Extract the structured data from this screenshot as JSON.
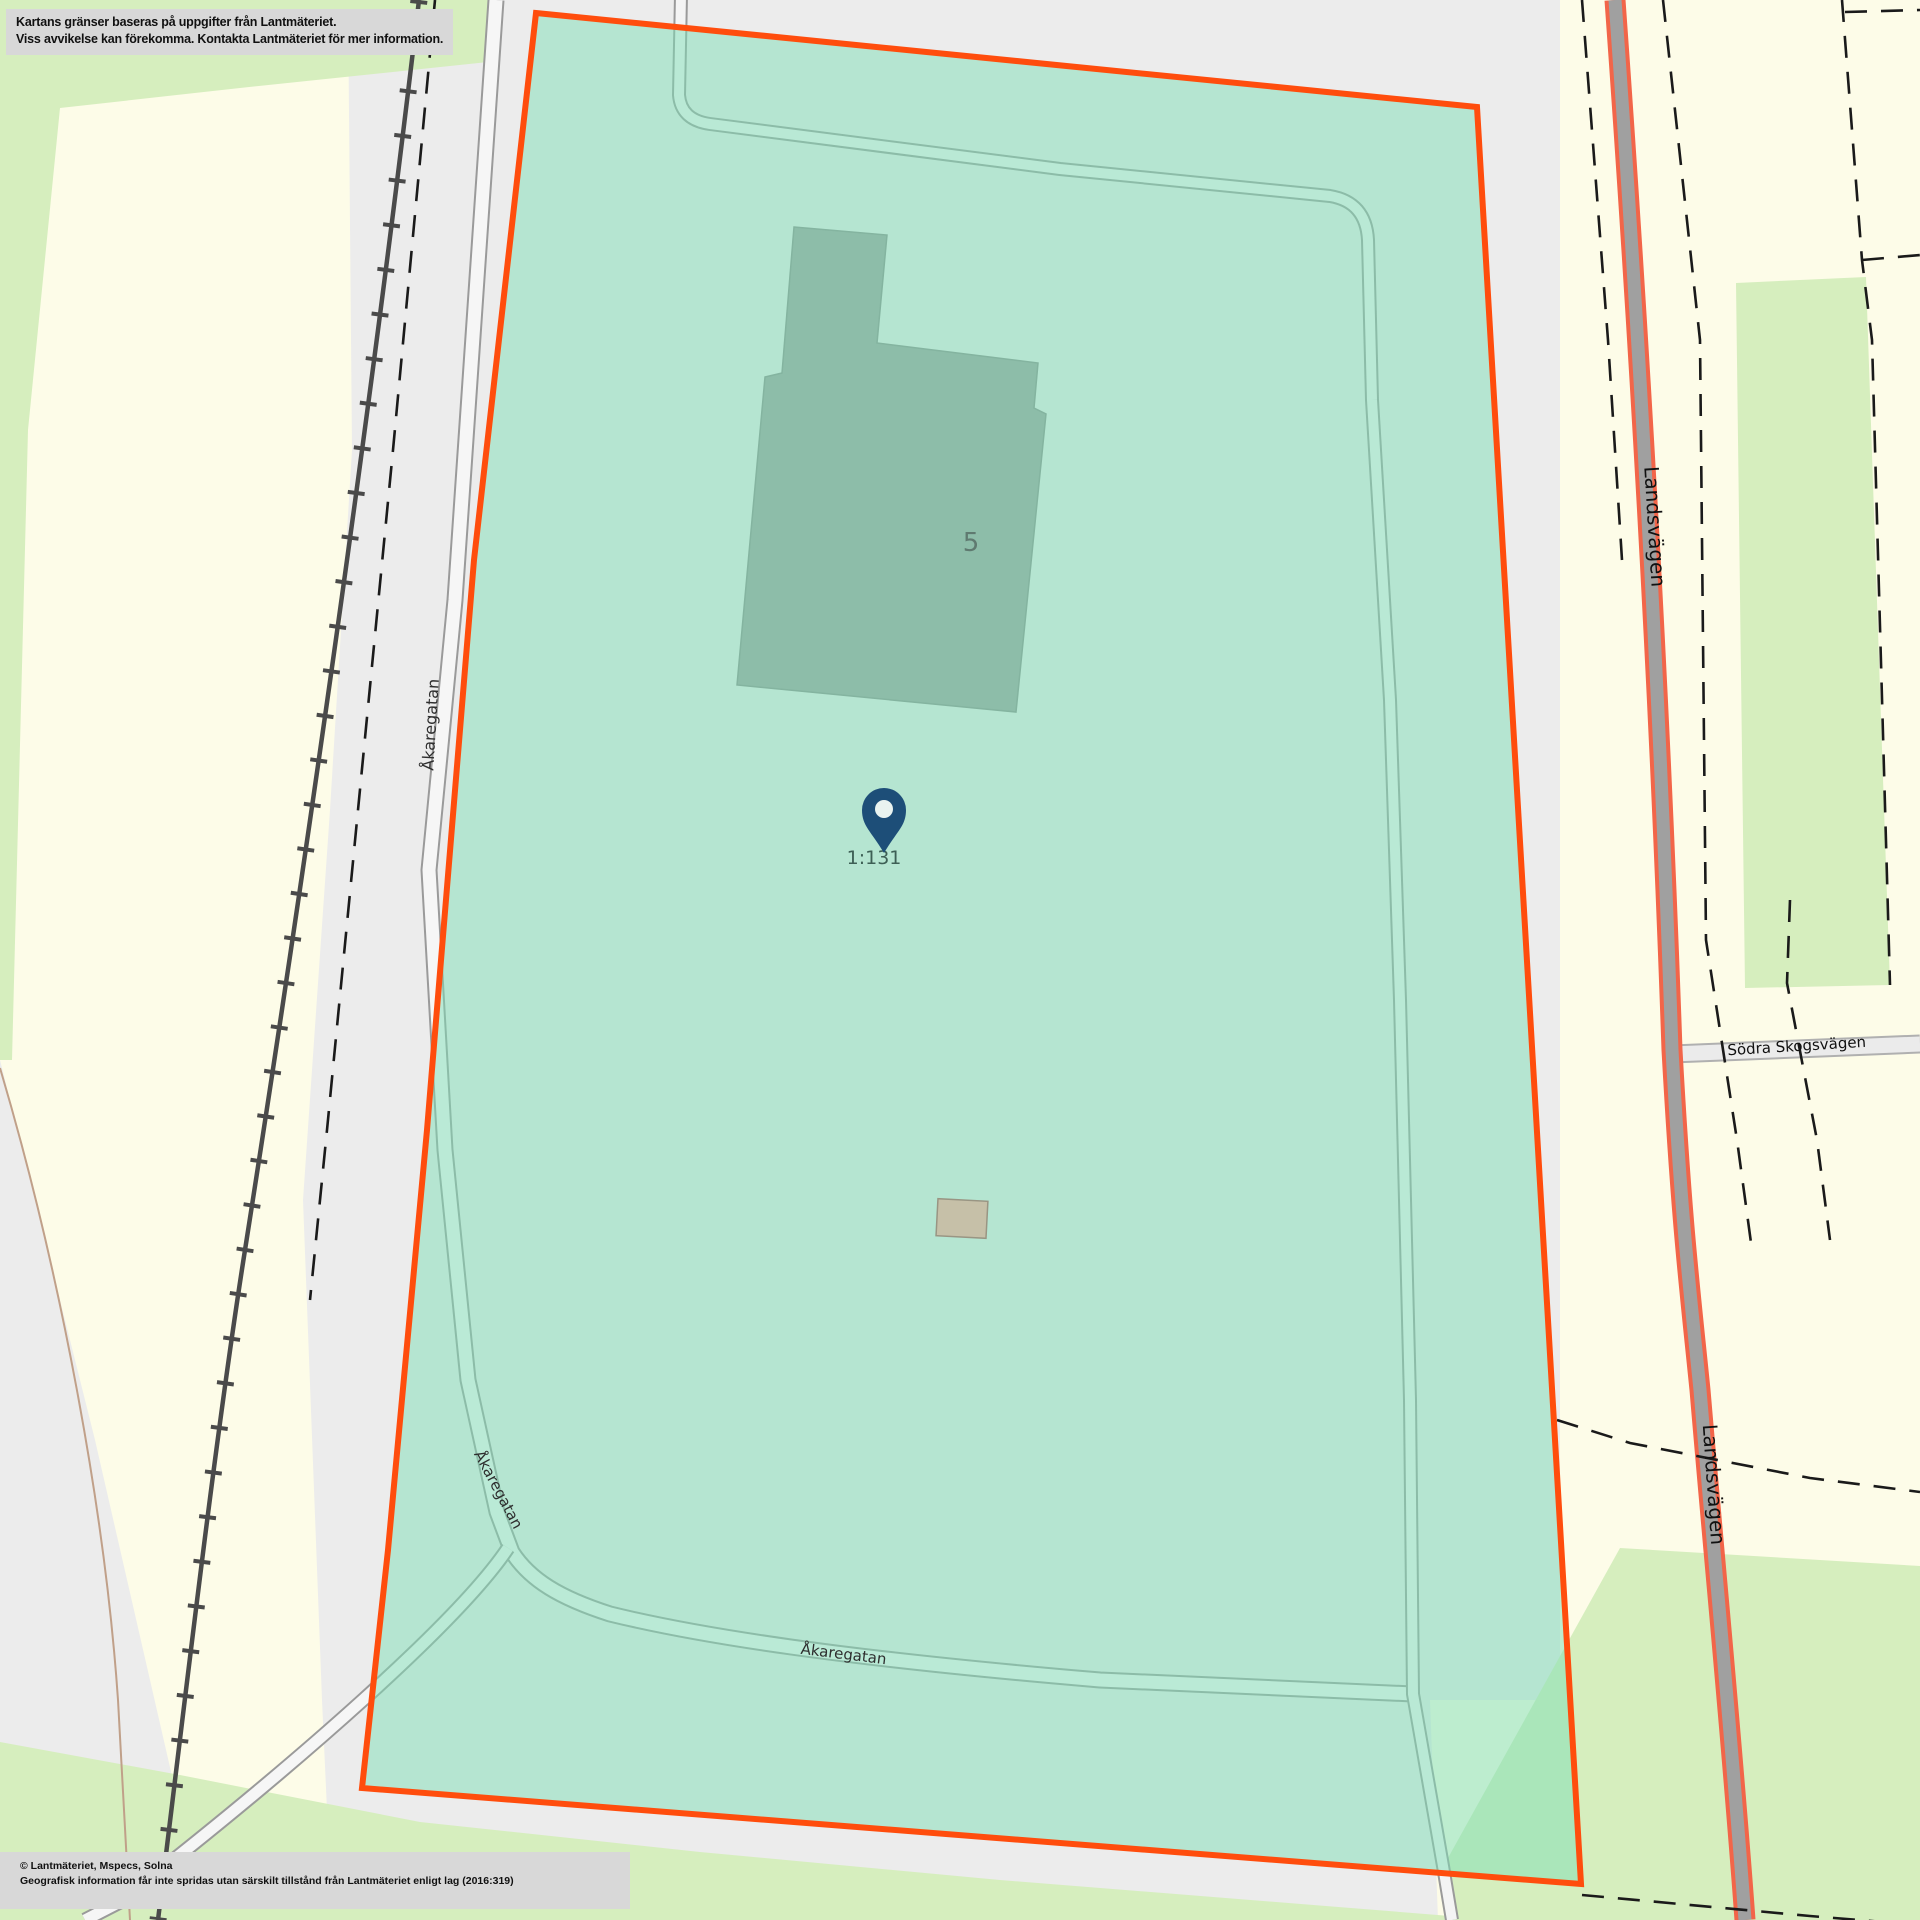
{
  "map": {
    "disclaimer": {
      "line1": "Kartans gränser baseras på uppgifter från Lantmäteriet.",
      "line2": "Viss avvikelse kan förekomma. Kontakta Lantmäteriet för mer information."
    },
    "attribution": {
      "line1": "© Lantmäteriet, Mspecs, Solna",
      "line2": "Geografisk information får inte spridas utan särskilt tillstånd från Lantmäteriet enligt lag (2016:319)"
    },
    "labels": {
      "street_akaregatan": "Åkaregatan",
      "street_landsvagen": "Landsvägen",
      "street_sodra_skogsvagen": "Södra Skogsvägen",
      "building_number": "5",
      "parcel_id": "1:131"
    },
    "legend": {
      "parcel_fill": "rgba(126,222,182,0.5)",
      "parcel_border": "#ff4d0d",
      "building_fill": "#9c9c9c",
      "small_building_fill": "#c6c0a8",
      "marker_color": "#1d4e78",
      "landsvagen_casing": "#f26549",
      "landsvagen_fill": "#a0a0a0",
      "railway_color": "#4a4a4a",
      "area_yellow": "#fdfce8",
      "area_green": "#d6eebe",
      "area_gray": "#ececec"
    }
  }
}
